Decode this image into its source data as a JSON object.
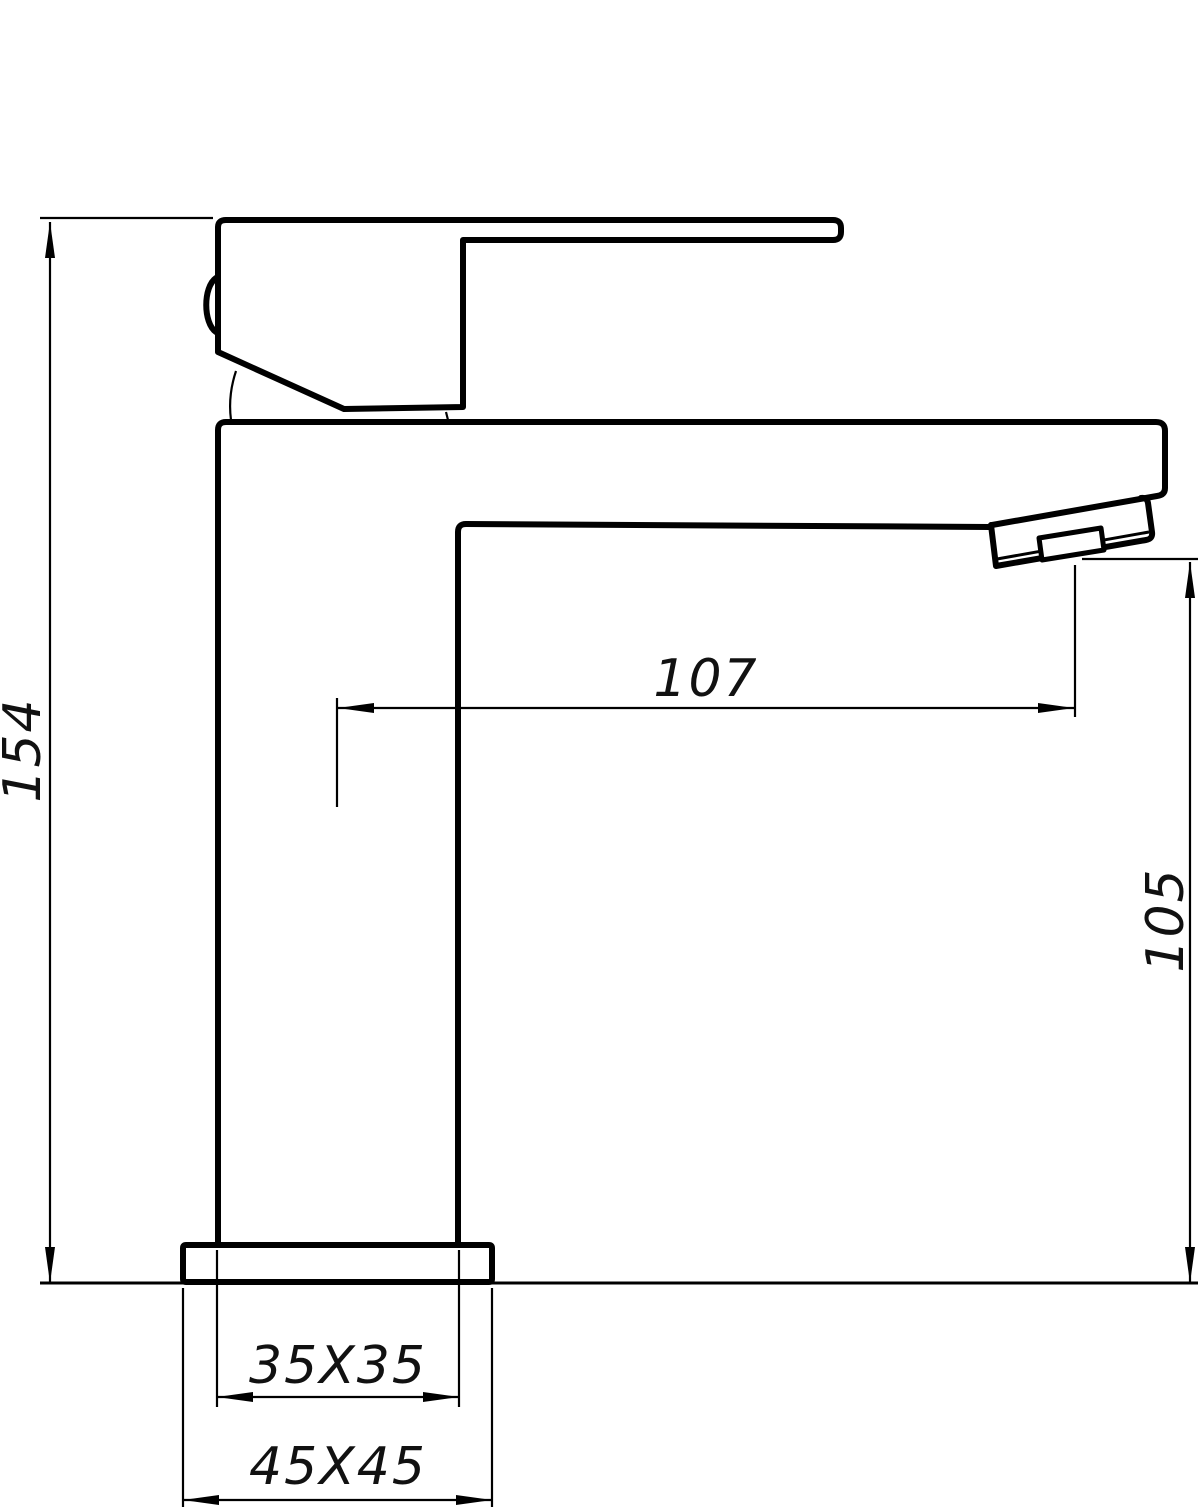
{
  "drawing": {
    "background_color": "#ffffff",
    "line_color": "#000000",
    "dimensions": {
      "total_height": "154",
      "spout_reach": "107",
      "outlet_height": "105",
      "body_section": "35X35",
      "base_section": "45X45"
    }
  }
}
